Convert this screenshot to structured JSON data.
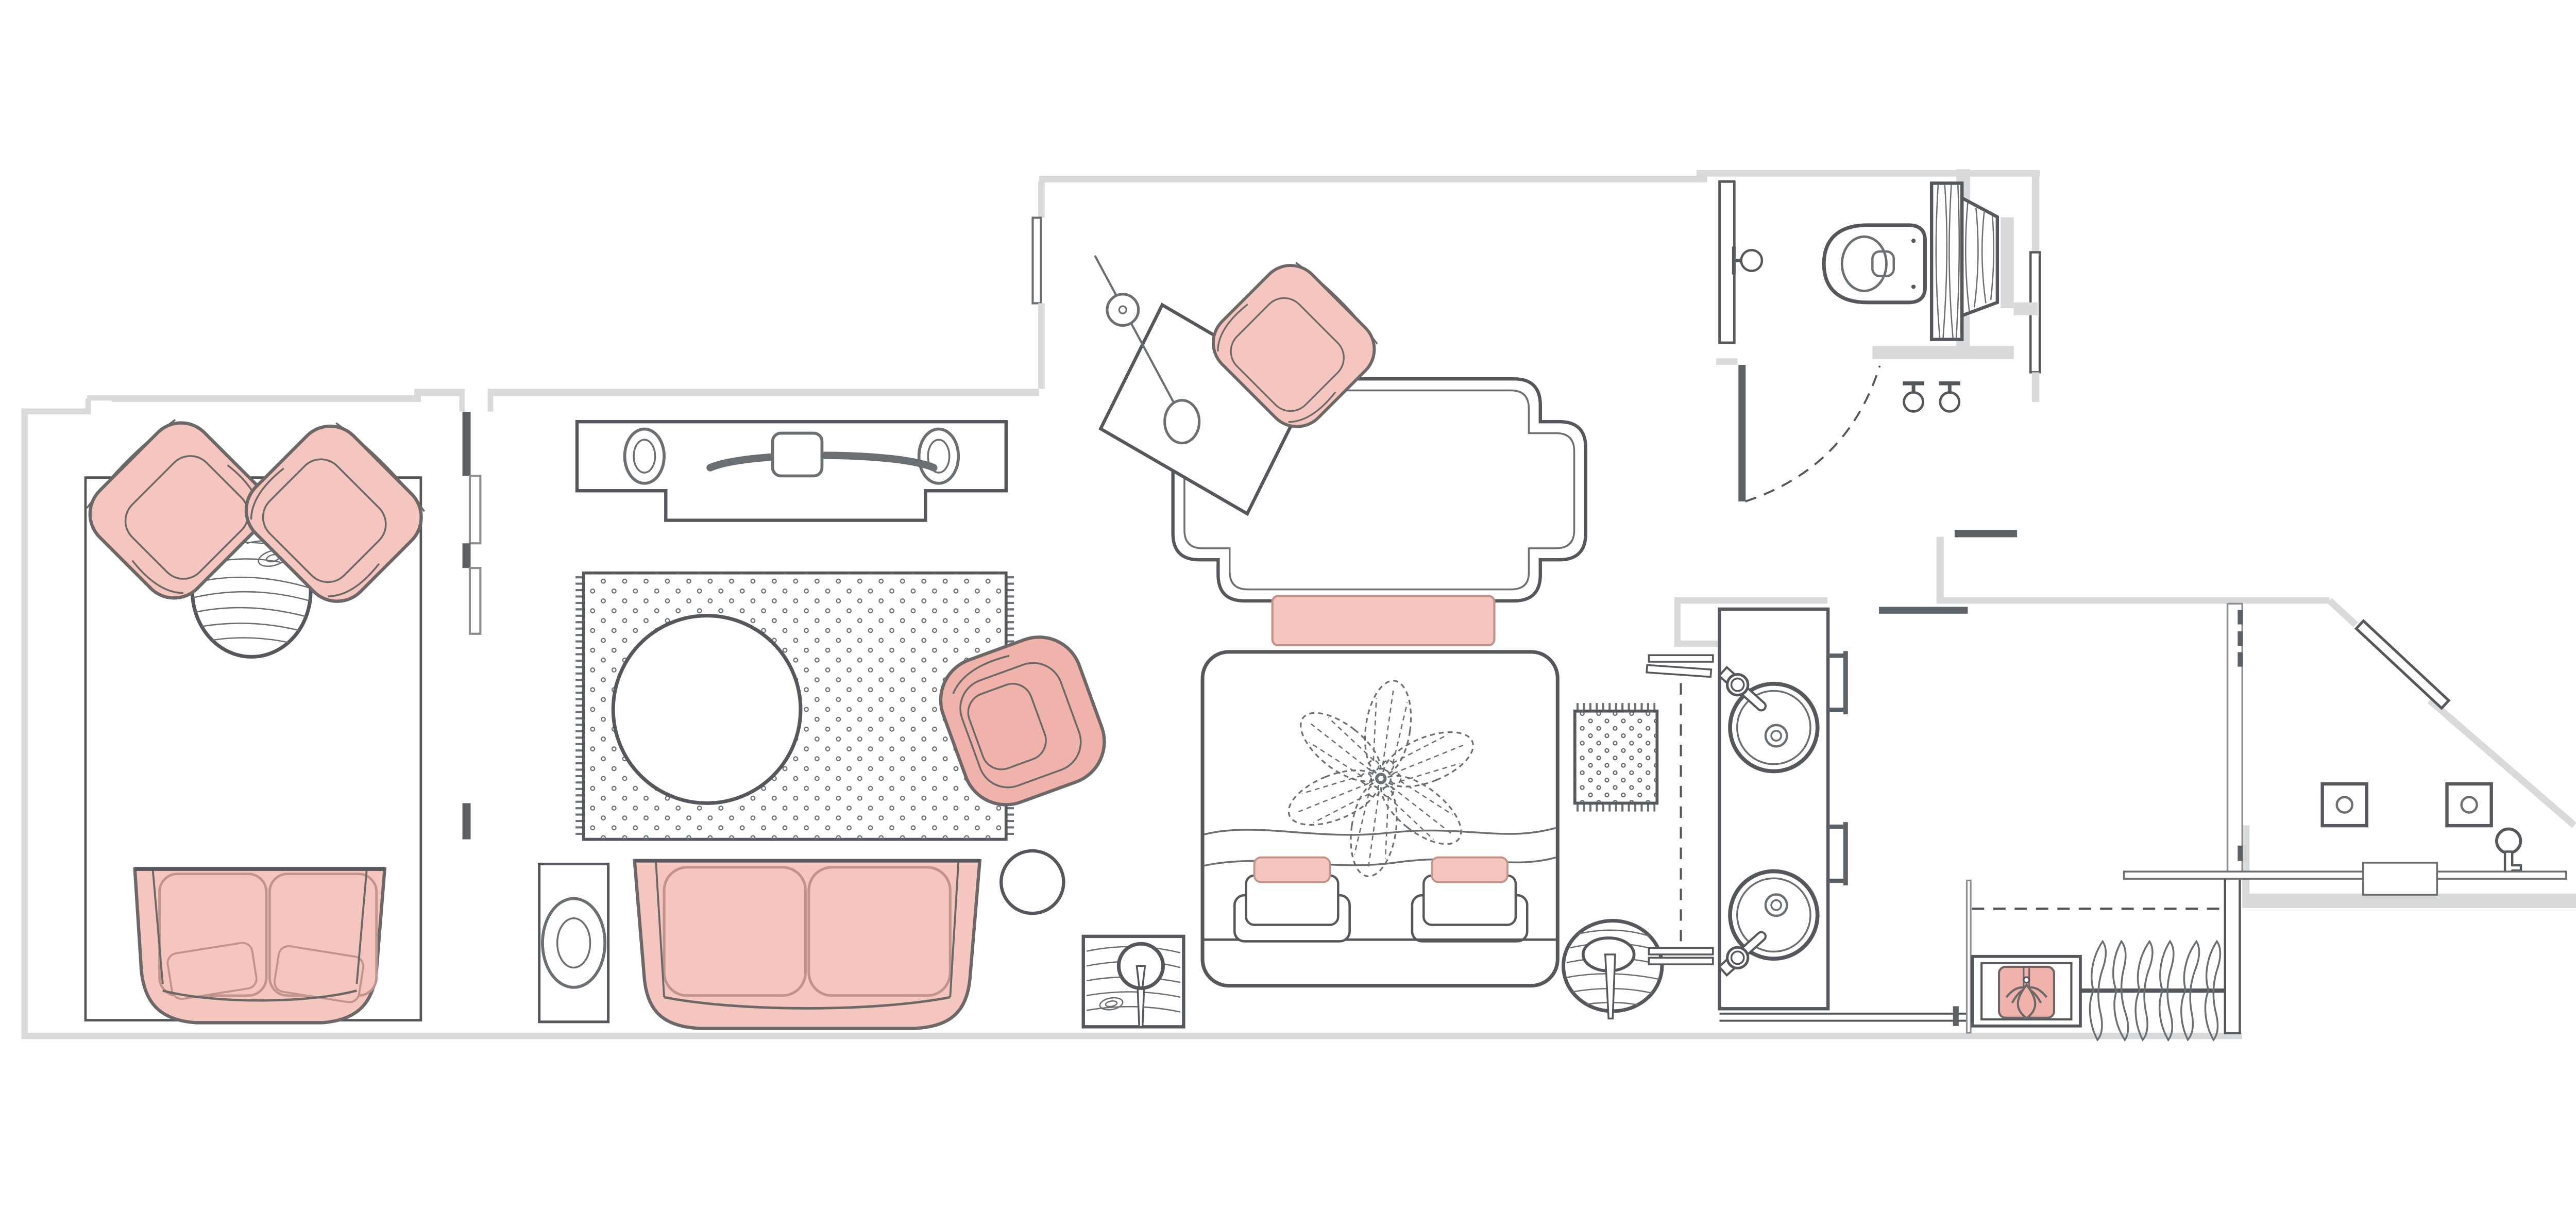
{
  "document": {
    "title": "Hotel suite floor plan — top view"
  },
  "palette": {
    "paper": "#ffffff",
    "wall": "#d8dadb",
    "wall_dark": "#5d6266",
    "outline": "#54585c",
    "line_mid": "#6a6f73",
    "line_light": "#8a9094",
    "accent": "#f4c6bf",
    "accent_deep": "#f0b3ab",
    "accent_outline": "#6d6768",
    "accent_outline_soft": "#c0938b",
    "dots": "#5f6468"
  },
  "rooms": {
    "patio": {
      "label": "Patio",
      "furniture": [
        "grid outdoor rug",
        "lounge chair",
        "lounge chair",
        "round wood table",
        "outdoor loveseat with 2 pillows"
      ]
    },
    "living": {
      "label": "Living room",
      "furniture": [
        "media console with 2 speakers and soundbar",
        "dotted fringe rug",
        "round coffee table",
        "swivel armchair",
        "round side table",
        "floor lamp",
        "two-seat sofa"
      ]
    },
    "desk_nook": {
      "label": "Work nook",
      "furniture": [
        "writing desk",
        "task lamp",
        "desk chair",
        "quatrefoil dotted rug"
      ]
    },
    "bedroom": {
      "label": "Bedroom",
      "furniture": [
        "bench at foot of bed",
        "king bed with flower medallion duvet",
        "2 pillow sets (accent + sleeping + euro)",
        "square wood nightstand with lamp",
        "round wood nightstand with lamp",
        "dotted runner rug",
        "wall shelves"
      ]
    },
    "wc": {
      "label": "Toilet room",
      "furniture": [
        "toilet",
        "wood cistern panel",
        "toilet-paper holder",
        "2 robe hooks",
        "swing door"
      ]
    },
    "vanity": {
      "label": "Bath vanity",
      "furniture": [
        "double vanity counter",
        "2 round vessel sinks",
        "2 lever faucets",
        "2 towel ladders",
        "towel rail"
      ]
    },
    "closet": {
      "label": "Closet",
      "furniture": [
        "safe / drawer unit with folded shirt",
        "hanging rod",
        "6 hangers"
      ]
    },
    "entry": {
      "label": "Entry",
      "furniture": [
        "entry door on angled wall",
        "2 switch plates",
        "door key",
        "threshold"
      ]
    }
  },
  "counts": {
    "hangers": 6,
    "sinks": 2,
    "patio_chairs": 2,
    "sofa_cushions": 2,
    "flower_petals": 6
  }
}
